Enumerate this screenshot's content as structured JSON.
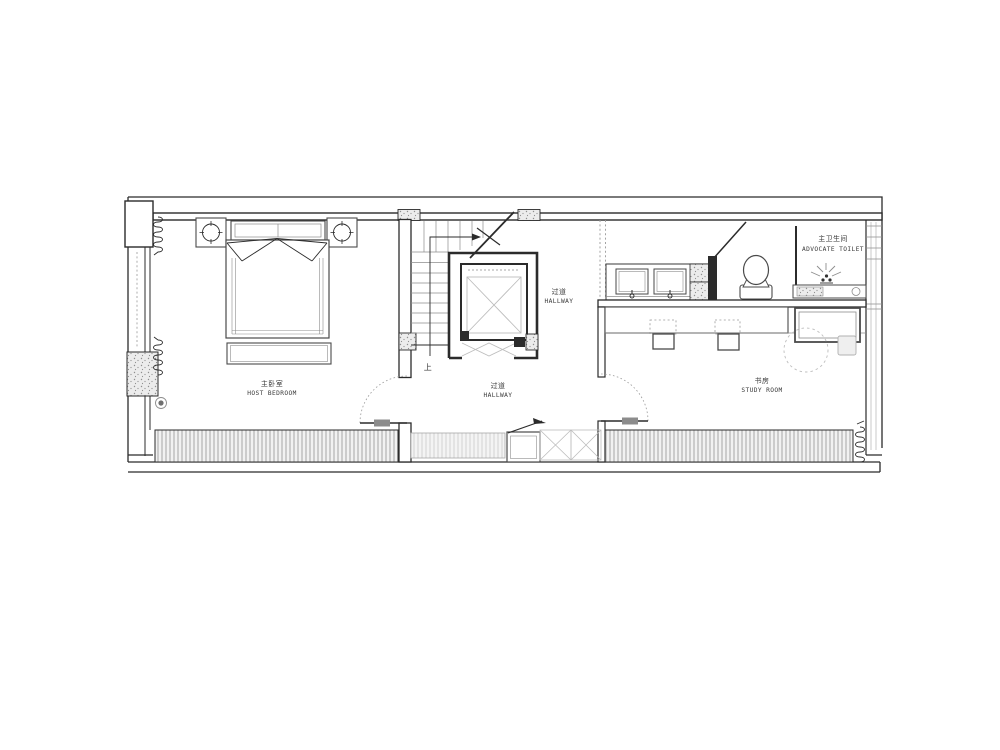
{
  "document": {
    "type": "architectural-floor-plan"
  },
  "rooms": {
    "master_bedroom": {
      "label_zh": "主卧室",
      "label_en": "HOST BEDROOM"
    },
    "hallway_upper": {
      "label_zh": "过道",
      "label_en": "HALLWAY"
    },
    "hallway_lower": {
      "label_zh": "过道",
      "label_en": "HALLWAY"
    },
    "study_room": {
      "label_zh": "书房",
      "label_en": "STUDY ROOM"
    },
    "master_toilet": {
      "label_zh": "主卫生间",
      "label_en": "ADVOCATE TOILET"
    }
  },
  "annotations": {
    "stair_direction": "上"
  },
  "colors": {
    "wall_line": "#2b2b2b",
    "furniture_line": "#4a4a4a",
    "light_line": "#bdbdbd",
    "hatch_line": "#a6a6a6",
    "label_text": "#3a3a3a",
    "background": "#ffffff"
  }
}
